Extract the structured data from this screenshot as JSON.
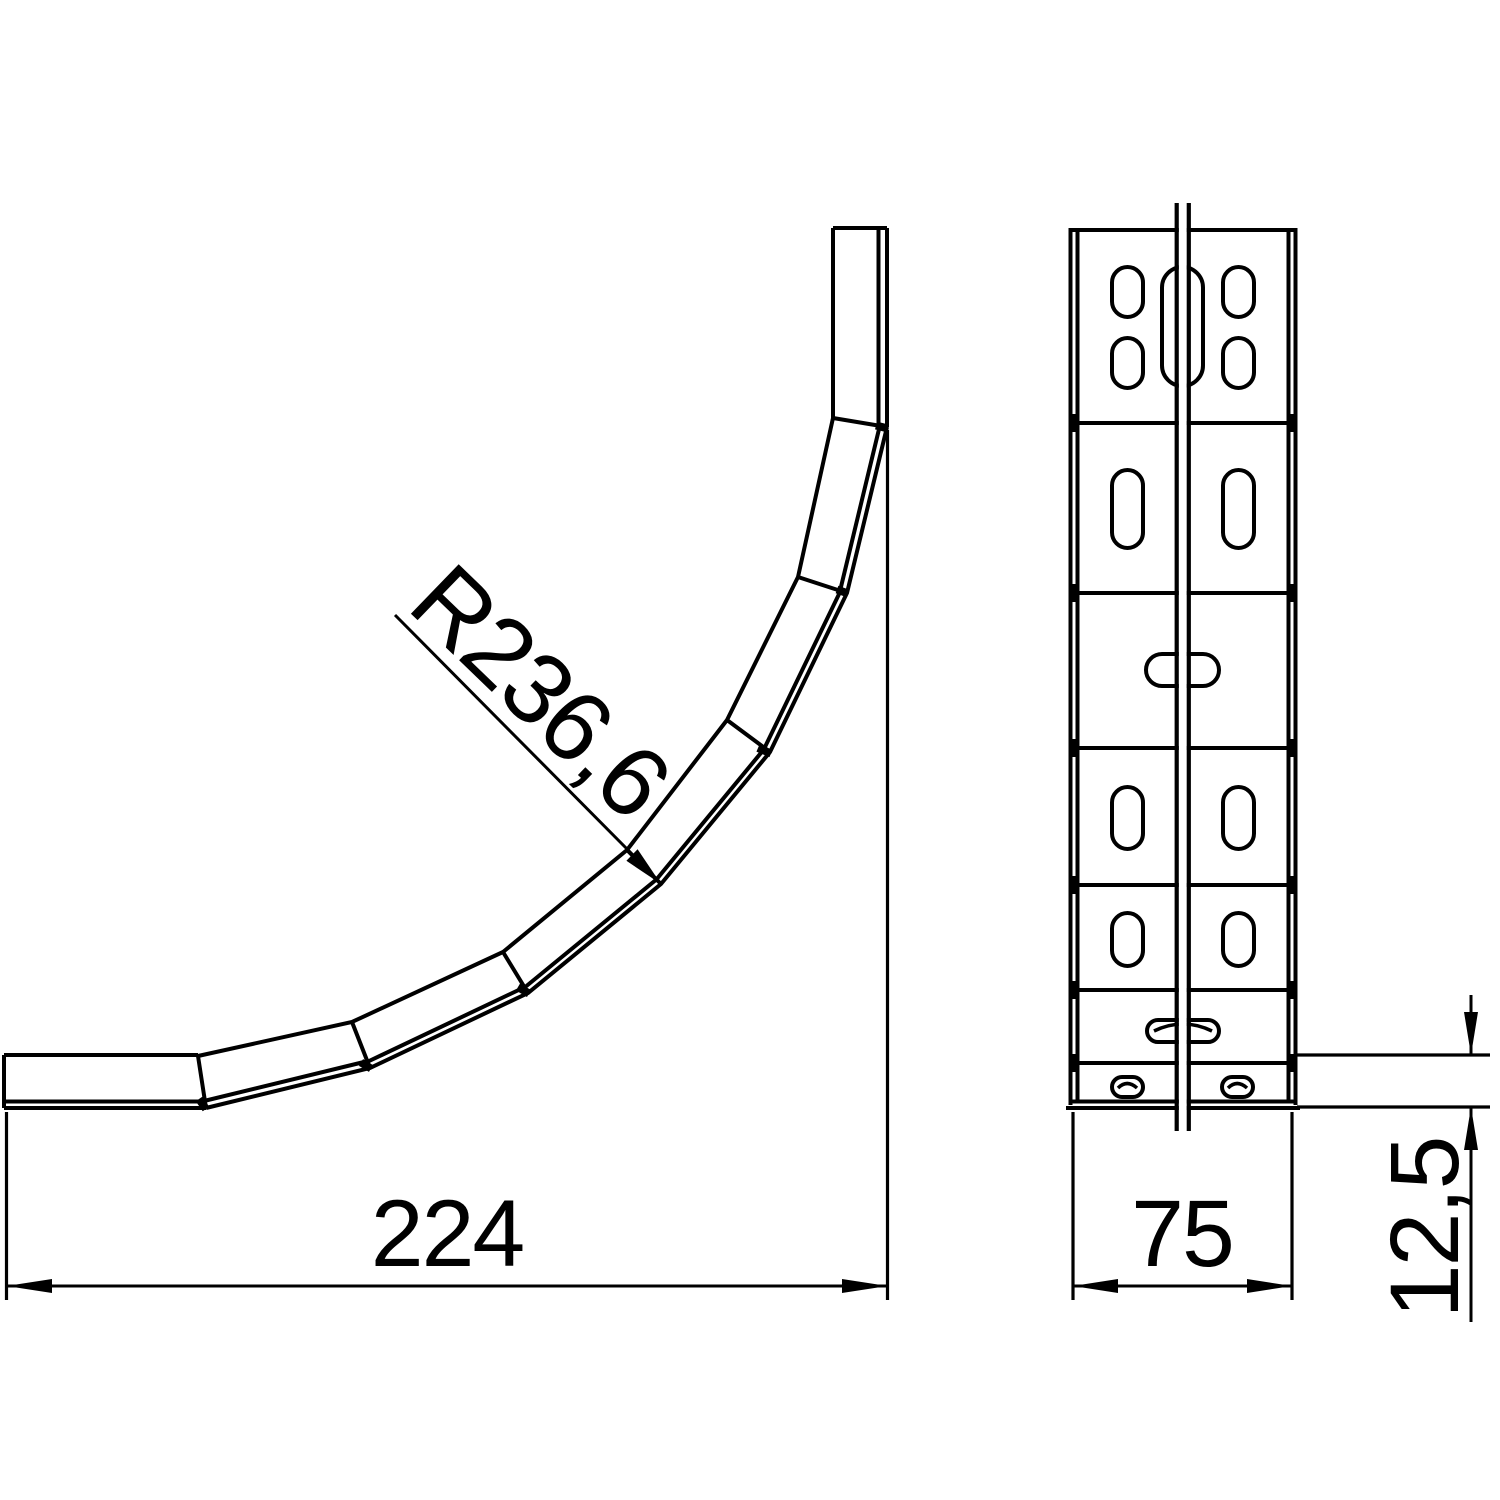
{
  "page": {
    "background_color": "#ffffff"
  },
  "drawing": {
    "line_color": "#000000",
    "side_view": {
      "radius_dimension": "R236,6",
      "length_dimension": "224"
    },
    "front_view": {
      "width_dimension": "75",
      "flange_height_dimension": "12,5"
    }
  }
}
